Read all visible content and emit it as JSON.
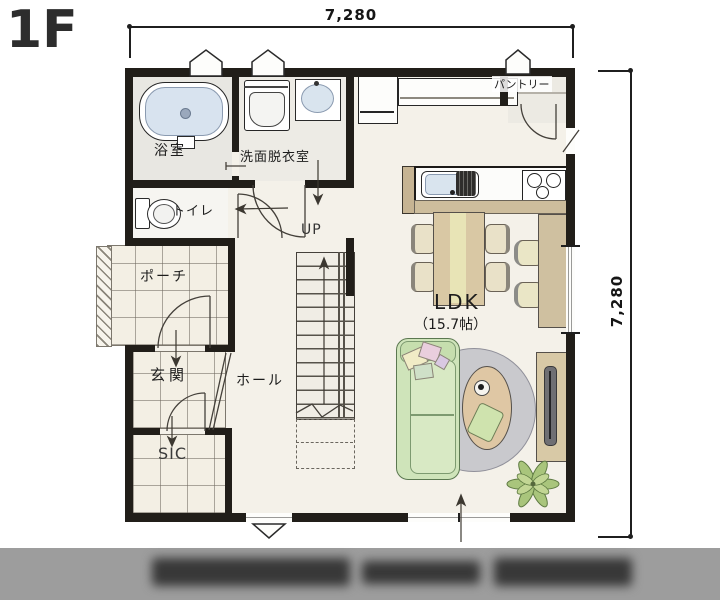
{
  "header": {
    "floor_label": "1F"
  },
  "dimensions": {
    "top": "7,280",
    "right": "7,280"
  },
  "rooms": {
    "bath": {
      "label": "浴室"
    },
    "washroom": {
      "label": "洗面脱衣室"
    },
    "toilet": {
      "label": "トイレ"
    },
    "porch": {
      "label": "ポーチ"
    },
    "entrance": {
      "label": "玄関"
    },
    "shoe_closet": {
      "label": "SIC"
    },
    "hall": {
      "label": "ホール"
    },
    "pantry": {
      "label": "パントリー"
    },
    "ldk": {
      "label": "LDK",
      "size": "（15.7帖）"
    },
    "stairs": {
      "label": "UP"
    }
  },
  "colors": {
    "wall": "#211e19",
    "floor": "#f4f1e9",
    "tile": "#f3efe4",
    "bath_floor": "#e8e7e2",
    "water_blue": "#d9e4ee",
    "wood_counter": "#cfc0a0",
    "table_wood": "#d9c8a4",
    "sofa_green": "#cfe4ba",
    "rug_gray": "#c9c9cd",
    "plant_green": "#a9c57c",
    "caption_bar": "#9d9d9d"
  },
  "footer": {
    "caption_redacted": true
  }
}
